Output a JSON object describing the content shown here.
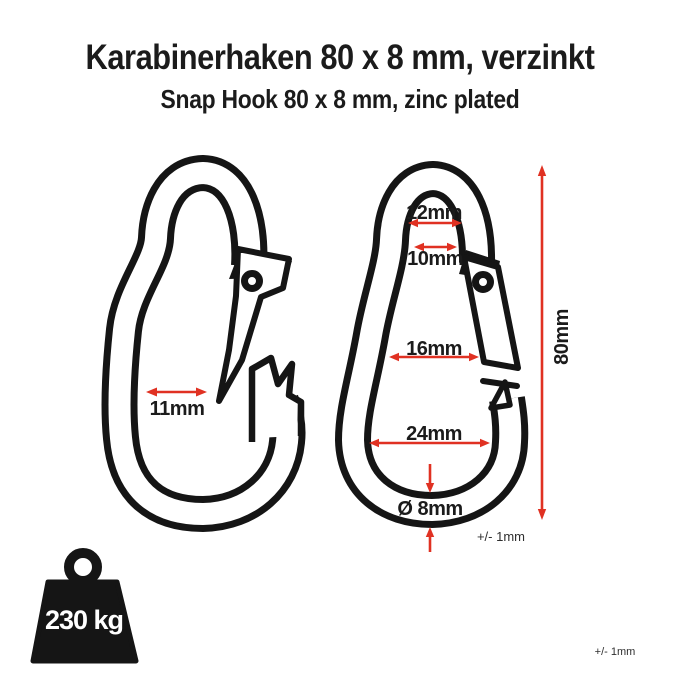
{
  "header": {
    "title": "Karabinerhaken 80 x 8 mm, verzinkt",
    "subtitle": "Snap Hook 80 x 8 mm, zinc plated"
  },
  "colors": {
    "background": "#ffffff",
    "line": "#151515",
    "dimension_red": "#e03122",
    "label_text": "#1b1b1b"
  },
  "dimensions": {
    "gate_opening": "11mm",
    "top_inner_width": "12mm",
    "top_neck_width": "10mm",
    "middle_inner_width": "16mm",
    "bottom_inner_width": "24mm",
    "wire_diameter": "Ø 8mm",
    "total_length": "80mm"
  },
  "tolerances": {
    "diameter_tolerance": "+/- 1mm",
    "general_tolerance": "+/- 1mm"
  },
  "load": {
    "capacity": "230 kg"
  }
}
